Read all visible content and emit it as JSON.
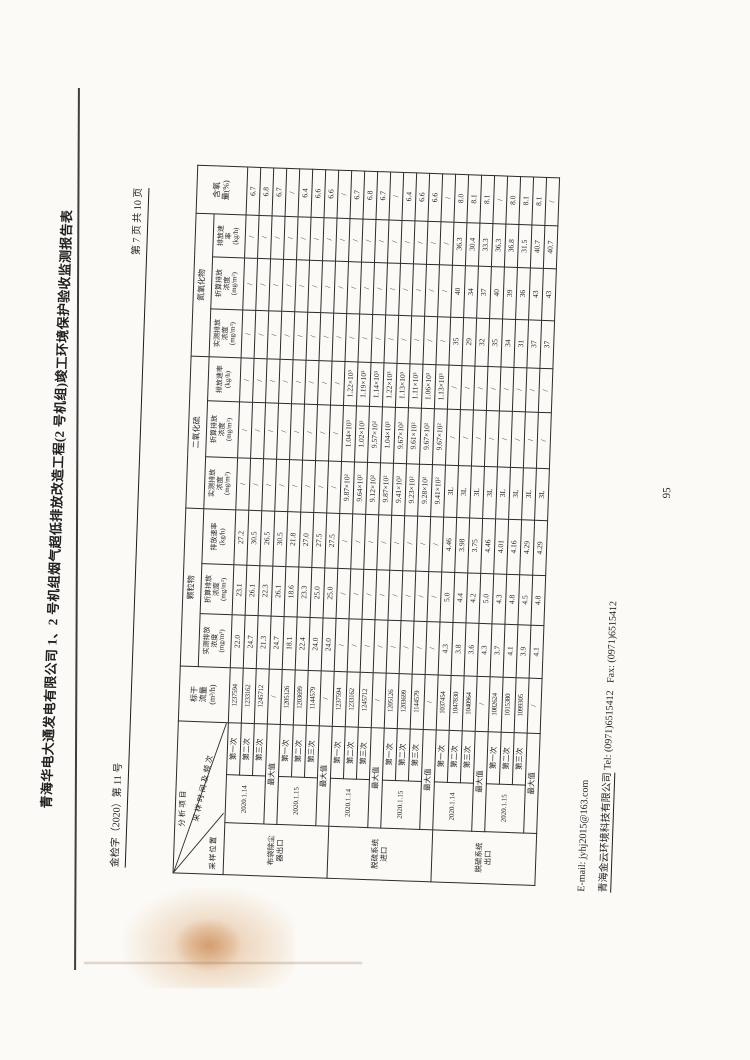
{
  "page": {
    "title": "青海华电大通发电有限公司 1、2 号机组烟气超低排放改造工程(2 号机组)竣工环境保护验收监测报告表",
    "doc_number": "金检字（2020）第 11 号",
    "page_indicator": "第 7 页 共 10 页",
    "page_number": "95",
    "footer_email": "E-mail: jyhj2015@163.com",
    "footer_company": "青海金云环境科技有限公司",
    "footer_tel": "Tel: (0971)6515412",
    "footer_fax": "Fax: (0971)6515412",
    "colors": {
      "paper": "#fbfaf7",
      "ink": "#1f1f1f",
      "table_border": "#2b2b2b",
      "stain": "#cb7b35"
    }
  },
  "table": {
    "headers": {
      "corner": {
        "top": "分析项目",
        "mid": "采样时间及频次",
        "bottom": "采样位置"
      },
      "flow": "标干\n流量\n(m³/h)",
      "o2": "含氧\n量(%)",
      "groups": [
        {
          "name": "颗粒物",
          "cols": [
            "实测排放\n浓度\n(mg/m³)",
            "折算排放\n浓度\n(mg/m³)",
            "排放速率\n(kg/h)"
          ]
        },
        {
          "name": "二氧化硫",
          "cols": [
            "实测排放\n浓度\n(mg/m³)",
            "折算排放\n浓度\n(mg/m³)",
            "排放速率\n(kg/h)"
          ]
        },
        {
          "name": "氮氧化物",
          "cols": [
            "实测排放\n浓度\n(mg/m³)",
            "折算排放\n浓度\n(mg/m³)",
            "排放速\n率\n(kg/h)"
          ]
        }
      ],
      "run_labels": [
        "第一次",
        "第二次",
        "第三次"
      ],
      "max_label": "最大值",
      "col_widths": [
        52,
        48,
        52,
        55,
        53,
        50,
        55,
        52,
        56,
        44,
        48,
        52,
        43,
        48
      ]
    },
    "sections": [
      {
        "position": "布袋除尘\n器出口",
        "blocks": [
          {
            "date": "2020.1.14",
            "runs": [
              {
                "flow": "1237594",
                "vals": [
                  "22.0",
                  "23.1",
                  "27.2",
                  "/",
                  "/",
                  "/",
                  "/",
                  "/",
                  "/",
                  "6.7"
                ]
              },
              {
                "flow": "1233162",
                "vals": [
                  "24.7",
                  "26.1",
                  "30.5",
                  "/",
                  "/",
                  "/",
                  "/",
                  "/",
                  "/",
                  "6.8"
                ]
              },
              {
                "flow": "1245712",
                "vals": [
                  "21.3",
                  "22.3",
                  "26.5",
                  "/",
                  "/",
                  "/",
                  "/",
                  "/",
                  "/",
                  "6.7"
                ]
              }
            ],
            "max": {
              "flow": "/",
              "vals": [
                "24.7",
                "26.1",
                "30.5",
                "/",
                "/",
                "/",
                "/",
                "/",
                "/",
                "/"
              ]
            }
          },
          {
            "date": "2020.1.15",
            "runs": [
              {
                "flow": "1205126",
                "vals": [
                  "18.1",
                  "18.6",
                  "21.8",
                  "/",
                  "/",
                  "/",
                  "/",
                  "/",
                  "/",
                  "6.4"
                ]
              },
              {
                "flow": "1203699",
                "vals": [
                  "22.4",
                  "23.3",
                  "27.0",
                  "/",
                  "/",
                  "/",
                  "/",
                  "/",
                  "/",
                  "6.6"
                ]
              },
              {
                "flow": "1144579",
                "vals": [
                  "24.0",
                  "25.0",
                  "27.5",
                  "/",
                  "/",
                  "/",
                  "/",
                  "/",
                  "/",
                  "6.6"
                ]
              }
            ],
            "max": {
              "flow": "/",
              "vals": [
                "24.0",
                "25.0",
                "27.5",
                "/",
                "/",
                "/",
                "/",
                "/",
                "/",
                "/"
              ]
            }
          }
        ]
      },
      {
        "position": "脱硫系统\n进口",
        "blocks": [
          {
            "date": "2020.1.14",
            "runs": [
              {
                "flow": "1237594",
                "vals": [
                  "/",
                  "/",
                  "/",
                  "9.87×10²",
                  "1.04×10³",
                  "1.22×10³",
                  "/",
                  "/",
                  "/",
                  "6.7"
                ]
              },
              {
                "flow": "1233162",
                "vals": [
                  "/",
                  "/",
                  "/",
                  "9.64×10²",
                  "1.02×10³",
                  "1.19×10³",
                  "/",
                  "/",
                  "/",
                  "6.8"
                ]
              },
              {
                "flow": "1245712",
                "vals": [
                  "/",
                  "/",
                  "/",
                  "9.12×10²",
                  "9.57×10²",
                  "1.14×10³",
                  "/",
                  "/",
                  "/",
                  "6.7"
                ]
              }
            ],
            "max": {
              "flow": "/",
              "vals": [
                "/",
                "/",
                "/",
                "9.87×10²",
                "1.04×10³",
                "1.22×10³",
                "/",
                "/",
                "/",
                "/"
              ]
            }
          },
          {
            "date": "2020.1.15",
            "runs": [
              {
                "flow": "1205126",
                "vals": [
                  "/",
                  "/",
                  "/",
                  "9.41×10²",
                  "9.67×10²",
                  "1.13×10³",
                  "/",
                  "/",
                  "/",
                  "6.4"
                ]
              },
              {
                "flow": "1203699",
                "vals": [
                  "/",
                  "/",
                  "/",
                  "9.23×10²",
                  "9.61×10²",
                  "1.11×10³",
                  "/",
                  "/",
                  "/",
                  "6.6"
                ]
              },
              {
                "flow": "1144579",
                "vals": [
                  "/",
                  "/",
                  "/",
                  "9.28×10²",
                  "9.67×10²",
                  "1.06×10³",
                  "/",
                  "/",
                  "/",
                  "6.6"
                ]
              }
            ],
            "max": {
              "flow": "/",
              "vals": [
                "/",
                "/",
                "/",
                "9.41×10²",
                "9.67×10²",
                "1.13×10³",
                "/",
                "/",
                "/",
                "/"
              ]
            }
          }
        ]
      },
      {
        "position": "脱硫系统\n出口",
        "blocks": [
          {
            "date": "2020.1.14",
            "runs": [
              {
                "flow": "1037454",
                "vals": [
                  "4.3",
                  "5.0",
                  "4.46",
                  "3L",
                  "/",
                  "/",
                  "35",
                  "40",
                  "36.3",
                  "8.0"
                ]
              },
              {
                "flow": "1047830",
                "vals": [
                  "3.8",
                  "4.4",
                  "3.98",
                  "3L",
                  "/",
                  "/",
                  "29",
                  "34",
                  "30.4",
                  "8.1"
                ]
              },
              {
                "flow": "1040964",
                "vals": [
                  "3.6",
                  "4.2",
                  "3.75",
                  "3L",
                  "/",
                  "/",
                  "32",
                  "37",
                  "33.3",
                  "8.1"
                ]
              }
            ],
            "max": {
              "flow": "/",
              "vals": [
                "4.3",
                "5.0",
                "4.46",
                "3L",
                "/",
                "/",
                "35",
                "40",
                "36.3",
                "/"
              ]
            }
          },
          {
            "date": "2020.1.15",
            "runs": [
              {
                "flow": "1082624",
                "vals": [
                  "3.7",
                  "4.3",
                  "4.01",
                  "3L",
                  "/",
                  "/",
                  "34",
                  "39",
                  "36.8",
                  "8.0"
                ]
              },
              {
                "flow": "1015380",
                "vals": [
                  "4.1",
                  "4.8",
                  "4.16",
                  "3L",
                  "/",
                  "/",
                  "31",
                  "36",
                  "31.5",
                  "8.1"
                ]
              },
              {
                "flow": "1099305",
                "vals": [
                  "3.9",
                  "4.5",
                  "4.29",
                  "3L",
                  "/",
                  "/",
                  "37",
                  "43",
                  "40.7",
                  "8.1"
                ]
              }
            ],
            "max": {
              "flow": "/",
              "vals": [
                "4.1",
                "4.8",
                "4.29",
                "3L",
                "/",
                "/",
                "37",
                "43",
                "40.7",
                "/"
              ]
            }
          }
        ]
      }
    ]
  }
}
